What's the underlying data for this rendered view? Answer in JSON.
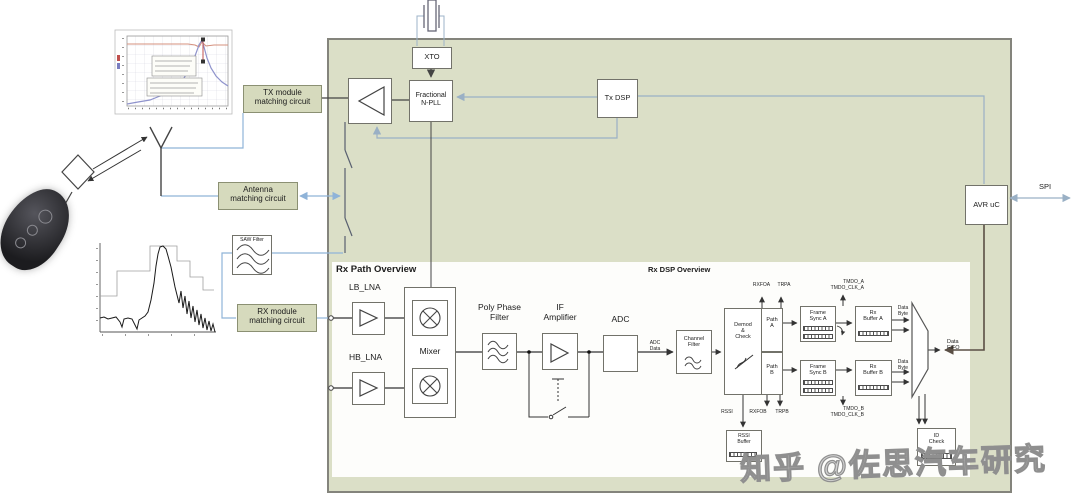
{
  "colors": {
    "chip_bg": "#dbdfc7",
    "panel_bg": "#fdfdfb",
    "matching_box_bg": "#d6dabd",
    "blue_line": "#8fb3d8",
    "gray_blue_line": "#9ab0c5",
    "dark_line": "#444444",
    "data_line": "#5a4f45",
    "trace_red": "#d4907e",
    "trace_blue": "#8f93cc"
  },
  "watermark": {
    "text": "知乎 @佐思汽车研究"
  },
  "chip": {
    "xto": "XTO",
    "pll": "Fractional\nN-PLL",
    "tx_dsp": "Tx DSP",
    "avr": "AVR uC",
    "spi": "SPI"
  },
  "external": {
    "tx_matching": "TX module\nmatching circuit",
    "antenna_matching": "Antenna\nmatching circuit",
    "saw_filter": "SAW Filter",
    "rx_matching": "RX module\nmatching circuit"
  },
  "rx_path": {
    "title": "Rx Path Overview",
    "lb_lna": "LB_LNA",
    "hb_lna": "HB_LNA",
    "mixer": "Mixer",
    "poly_phase_filter": "Poly Phase\nFilter",
    "if_amplifier": "IF\nAmplifier",
    "adc": "ADC",
    "adc_data": "ADC\nData"
  },
  "rx_dsp": {
    "title": "Rx DSP Overview",
    "channel_filter": "Channel\nFilter",
    "demod": "Demod\n&\nCheck",
    "path_a": "Path\nA",
    "path_b": "Path\nB",
    "rxfoa": "RXFOA",
    "trpa": "TRPA",
    "rssi": "RSSI",
    "rxfob": "RXFOB",
    "trpb": "TRPB",
    "tmdo_a": "TMDO_A\nTMDO_CLK_A",
    "tmdo_b": "TMDO_B\nTMDO_CLK_B",
    "frame_sync_a": "Frame\nSync A",
    "frame_sync_b": "Frame\nSync B",
    "rx_buffer_a": "Rx\nBuffer A",
    "rx_buffer_b": "Rx\nBuffer B",
    "data_byte": "Data\nByte",
    "data_fifo": "Data\nFIFO",
    "rssi_buffer": "RSSI\nBuffer",
    "id_check": "ID\nCheck"
  },
  "chart_data": [
    {
      "type": "line",
      "target": "chart1-series",
      "title": "",
      "xlabel": "",
      "ylabel": "",
      "grid": true,
      "series": [
        {
          "name": "reference-trace",
          "color": "#d4907e",
          "width": 1,
          "points": [
            [
              127,
              44
            ],
            [
              188,
              44
            ],
            [
              195,
              45
            ],
            [
              199,
              47
            ],
            [
              202,
              42
            ],
            [
              206,
              46
            ],
            [
              214,
              45
            ],
            [
              228,
              45
            ]
          ]
        },
        {
          "name": "resonance-trace",
          "color": "#8f93cc",
          "width": 1.2,
          "points": [
            [
              127,
              104
            ],
            [
              138,
              102
            ],
            [
              150,
              100
            ],
            [
              160,
              96
            ],
            [
              169,
              92
            ],
            [
              177,
              86
            ],
            [
              184,
              78
            ],
            [
              190,
              68
            ],
            [
              195,
              56
            ],
            [
              199,
              45
            ],
            [
              202,
              40
            ],
            [
              204,
              47
            ],
            [
              207,
              58
            ],
            [
              211,
              68
            ],
            [
              216,
              76
            ],
            [
              222,
              82
            ],
            [
              228,
              86
            ]
          ]
        }
      ]
    },
    {
      "type": "line",
      "target": "chart2-series",
      "title": "",
      "xlabel": "",
      "ylabel": "",
      "grid": false,
      "series": [
        {
          "name": "spectral-mask",
          "color": "#a0a0a0",
          "width": 0.8,
          "points": [
            [
              100,
              296
            ],
            [
              117,
              296
            ],
            [
              117,
              271
            ],
            [
              150,
              271
            ],
            [
              150,
              246
            ],
            [
              177,
              246
            ],
            [
              177,
              261
            ],
            [
              190,
              261
            ],
            [
              190,
              277
            ],
            [
              203,
              277
            ],
            [
              203,
              290
            ],
            [
              214,
              290
            ]
          ]
        },
        {
          "name": "saw-response",
          "color": "#1a1a1a",
          "width": 1,
          "points": [
            [
              100,
              318
            ],
            [
              104,
              317
            ],
            [
              108,
              319
            ],
            [
              112,
              318
            ],
            [
              116,
              317
            ],
            [
              120,
              322
            ],
            [
              122,
              327
            ],
            [
              124,
              319
            ],
            [
              128,
              318
            ],
            [
              132,
              319
            ],
            [
              135,
              325
            ],
            [
              137,
              329
            ],
            [
              139,
              320
            ],
            [
              142,
              318
            ],
            [
              145,
              316
            ],
            [
              148,
              312
            ],
            [
              151,
              300
            ],
            [
              154,
              283
            ],
            [
              156,
              266
            ],
            [
              158,
              254
            ],
            [
              160,
              247
            ],
            [
              163,
              246
            ],
            [
              166,
              249
            ],
            [
              168,
              256
            ],
            [
              171,
              267
            ],
            [
              173,
              277
            ],
            [
              175,
              287
            ],
            [
              177,
              295
            ],
            [
              179,
              303
            ],
            [
              181,
              291
            ],
            [
              183,
              308
            ],
            [
              185,
              296
            ],
            [
              187,
              314
            ],
            [
              189,
              301
            ],
            [
              191,
              318
            ],
            [
              193,
              306
            ],
            [
              195,
              322
            ],
            [
              197,
              310
            ],
            [
              199,
              325
            ],
            [
              201,
              314
            ],
            [
              203,
              328
            ],
            [
              205,
              318
            ],
            [
              207,
              330
            ],
            [
              209,
              321
            ],
            [
              211,
              331
            ],
            [
              213,
              324
            ],
            [
              215,
              332
            ]
          ]
        }
      ]
    }
  ]
}
